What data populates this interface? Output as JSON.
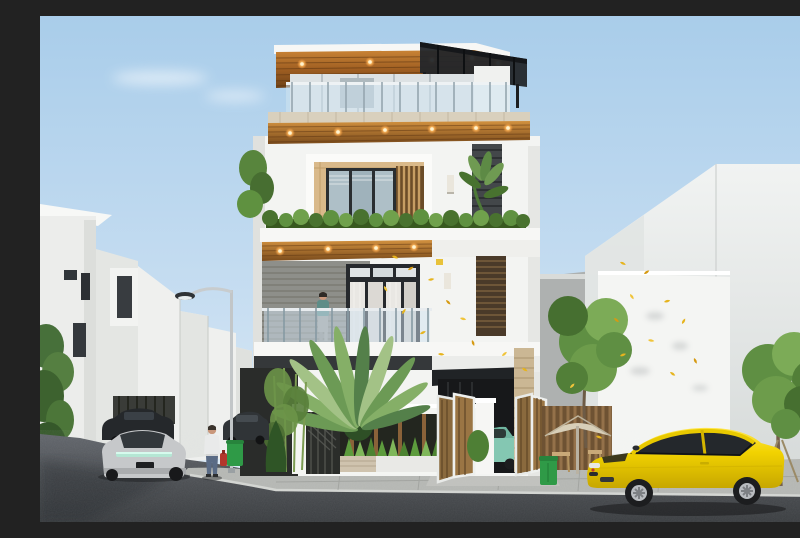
{
  "scene": {
    "type": "architectural-render",
    "aria_label": "3D exterior rendering of a modern four-storey townhouse with rooftop pergola terrace, wooden soffits with downlights, glass balconies, planted fence, carport with mint car, neighbouring white buildings, street lamp, pedestrians, a silver muscle car, dark sedans and a yellow sports coupe parked at the curb",
    "visible_text": [],
    "palette": {
      "sky_top": "#aecfea",
      "sky_bottom": "#dcebf6",
      "wood_warm": "#b5712f",
      "wood_dark": "#6e4218",
      "downlight_glow": "#ffc87a",
      "white_wall": "#f3f4f2",
      "dark_cladding": "#3c4043",
      "pergola_black": "#23262a",
      "glass_blue": "#c3d7e4",
      "stone_band": "#d9d0bd",
      "foliage_dark": "#3e6b2e",
      "foliage_mid": "#5f9140",
      "foliage_light": "#8fb468",
      "falling_leaf_yellow": "#e6b41e",
      "car_yellow": "#f2d301",
      "car_mint": "#84c7b2",
      "car_silver": "#c6c8ca",
      "asphalt": "#4e5154",
      "sidewalk": "#b7b9b5",
      "trash_bin_green": "#2f9a47",
      "hydrant_red": "#c0392b",
      "parasol_beige": "#d8cfb8"
    },
    "objects": [
      {
        "id": "sky",
        "label": "daytime sky with thin clouds"
      },
      {
        "id": "main-house",
        "label": "modern four-storey house, centre"
      },
      {
        "id": "rooftop-pergola",
        "label": "black sloped glass pergola on roof terrace"
      },
      {
        "id": "rooftop-glass-railing",
        "label": "frameless glass balustrade on roof"
      },
      {
        "id": "wood-soffit",
        "label": "warm wood ceiling soffits with round downlights"
      },
      {
        "id": "balcony-person",
        "label": "person standing on second floor balcony"
      },
      {
        "id": "hedge-planter",
        "label": "green hedge on third floor balcony edge"
      },
      {
        "id": "travellers-palm",
        "label": "large fan palm in front yard"
      },
      {
        "id": "front-fence",
        "label": "white fence with slatted screen and grasses"
      },
      {
        "id": "folding-gates",
        "label": "open white folding gates with wood louvres"
      },
      {
        "id": "carport-car",
        "label": "mint green car inside carport"
      },
      {
        "id": "left-buildings",
        "label": "white neighbouring houses, left street"
      },
      {
        "id": "street-lamp",
        "label": "curved street lamp"
      },
      {
        "id": "silver-muscle-car",
        "label": "silver muscle car, rear view, driving away"
      },
      {
        "id": "dark-sedans",
        "label": "dark parked sedans"
      },
      {
        "id": "pedestrian-man",
        "label": "man in white shirt near green bin"
      },
      {
        "id": "right-buildings",
        "label": "tall blank white buildings, right"
      },
      {
        "id": "parasol-seating",
        "label": "beige parasol with chairs by slat fence"
      },
      {
        "id": "yellow-coupe",
        "label": "yellow sports coupe parked at curb"
      },
      {
        "id": "staked-tree",
        "label": "young staked street tree"
      },
      {
        "id": "fire-hydrant",
        "label": "red fire hydrant on sidewalk"
      },
      {
        "id": "falling-leaves",
        "label": "yellow autumn leaves blowing in the wind"
      }
    ]
  }
}
